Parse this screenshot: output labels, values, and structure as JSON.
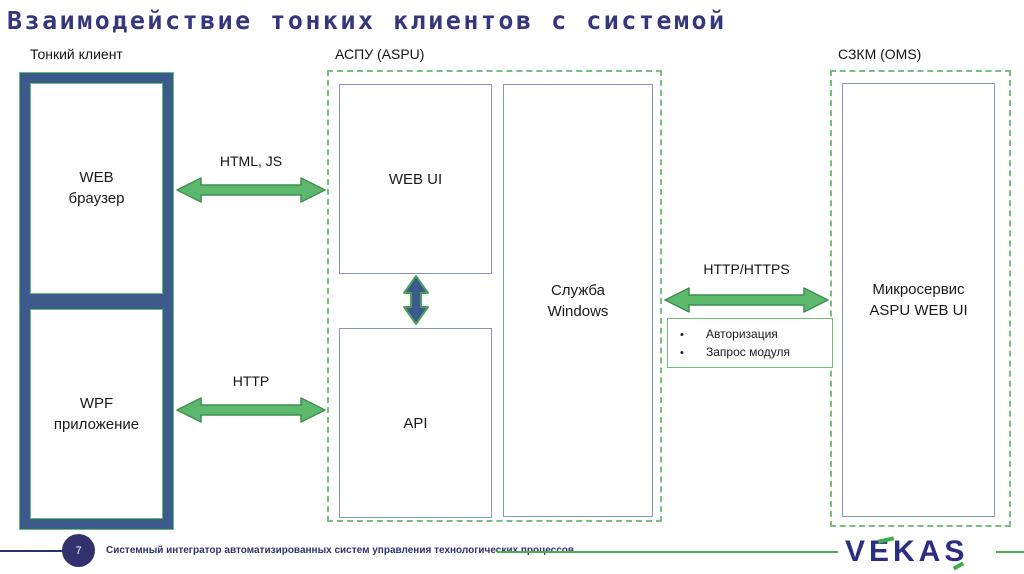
{
  "title": "Взаимодействие тонких клиентов с системой",
  "sections": {
    "thin_client": {
      "label": "Тонкий клиент",
      "web_browser": "WEB\nбраузер",
      "wpf_app": "WPF\nприложение"
    },
    "aspu": {
      "label": "АСПУ (ASPU)",
      "web_ui": "WEB UI",
      "api": "API",
      "windows_service": "Служба\nWindows"
    },
    "oms": {
      "label": "СЗКМ (OMS)",
      "microservice": "Микросервис\nASPU WEB UI"
    }
  },
  "connections": {
    "html_js": "HTML, JS",
    "http": "HTTP",
    "http_https": "HTTP/HTTPS"
  },
  "notes": {
    "items": [
      "Авторизация",
      "Запрос модуля"
    ]
  },
  "footer": {
    "page_number": "7",
    "caption": "Системный интегратор автоматизированных систем управления технологических процессов",
    "logo_text": "VEKAS"
  },
  "colors": {
    "arrow_green_fill": "#5CB96B",
    "arrow_green_stroke": "#3F8F51",
    "dashed_green": "#77C07F",
    "frame_navy": "#3C5A8C",
    "title_navy": "#36367E",
    "footer_navy": "#31316E",
    "logo_navy": "#2B2E83",
    "logo_green": "#3FAE49",
    "inner_border_slate": "#8794C4"
  }
}
